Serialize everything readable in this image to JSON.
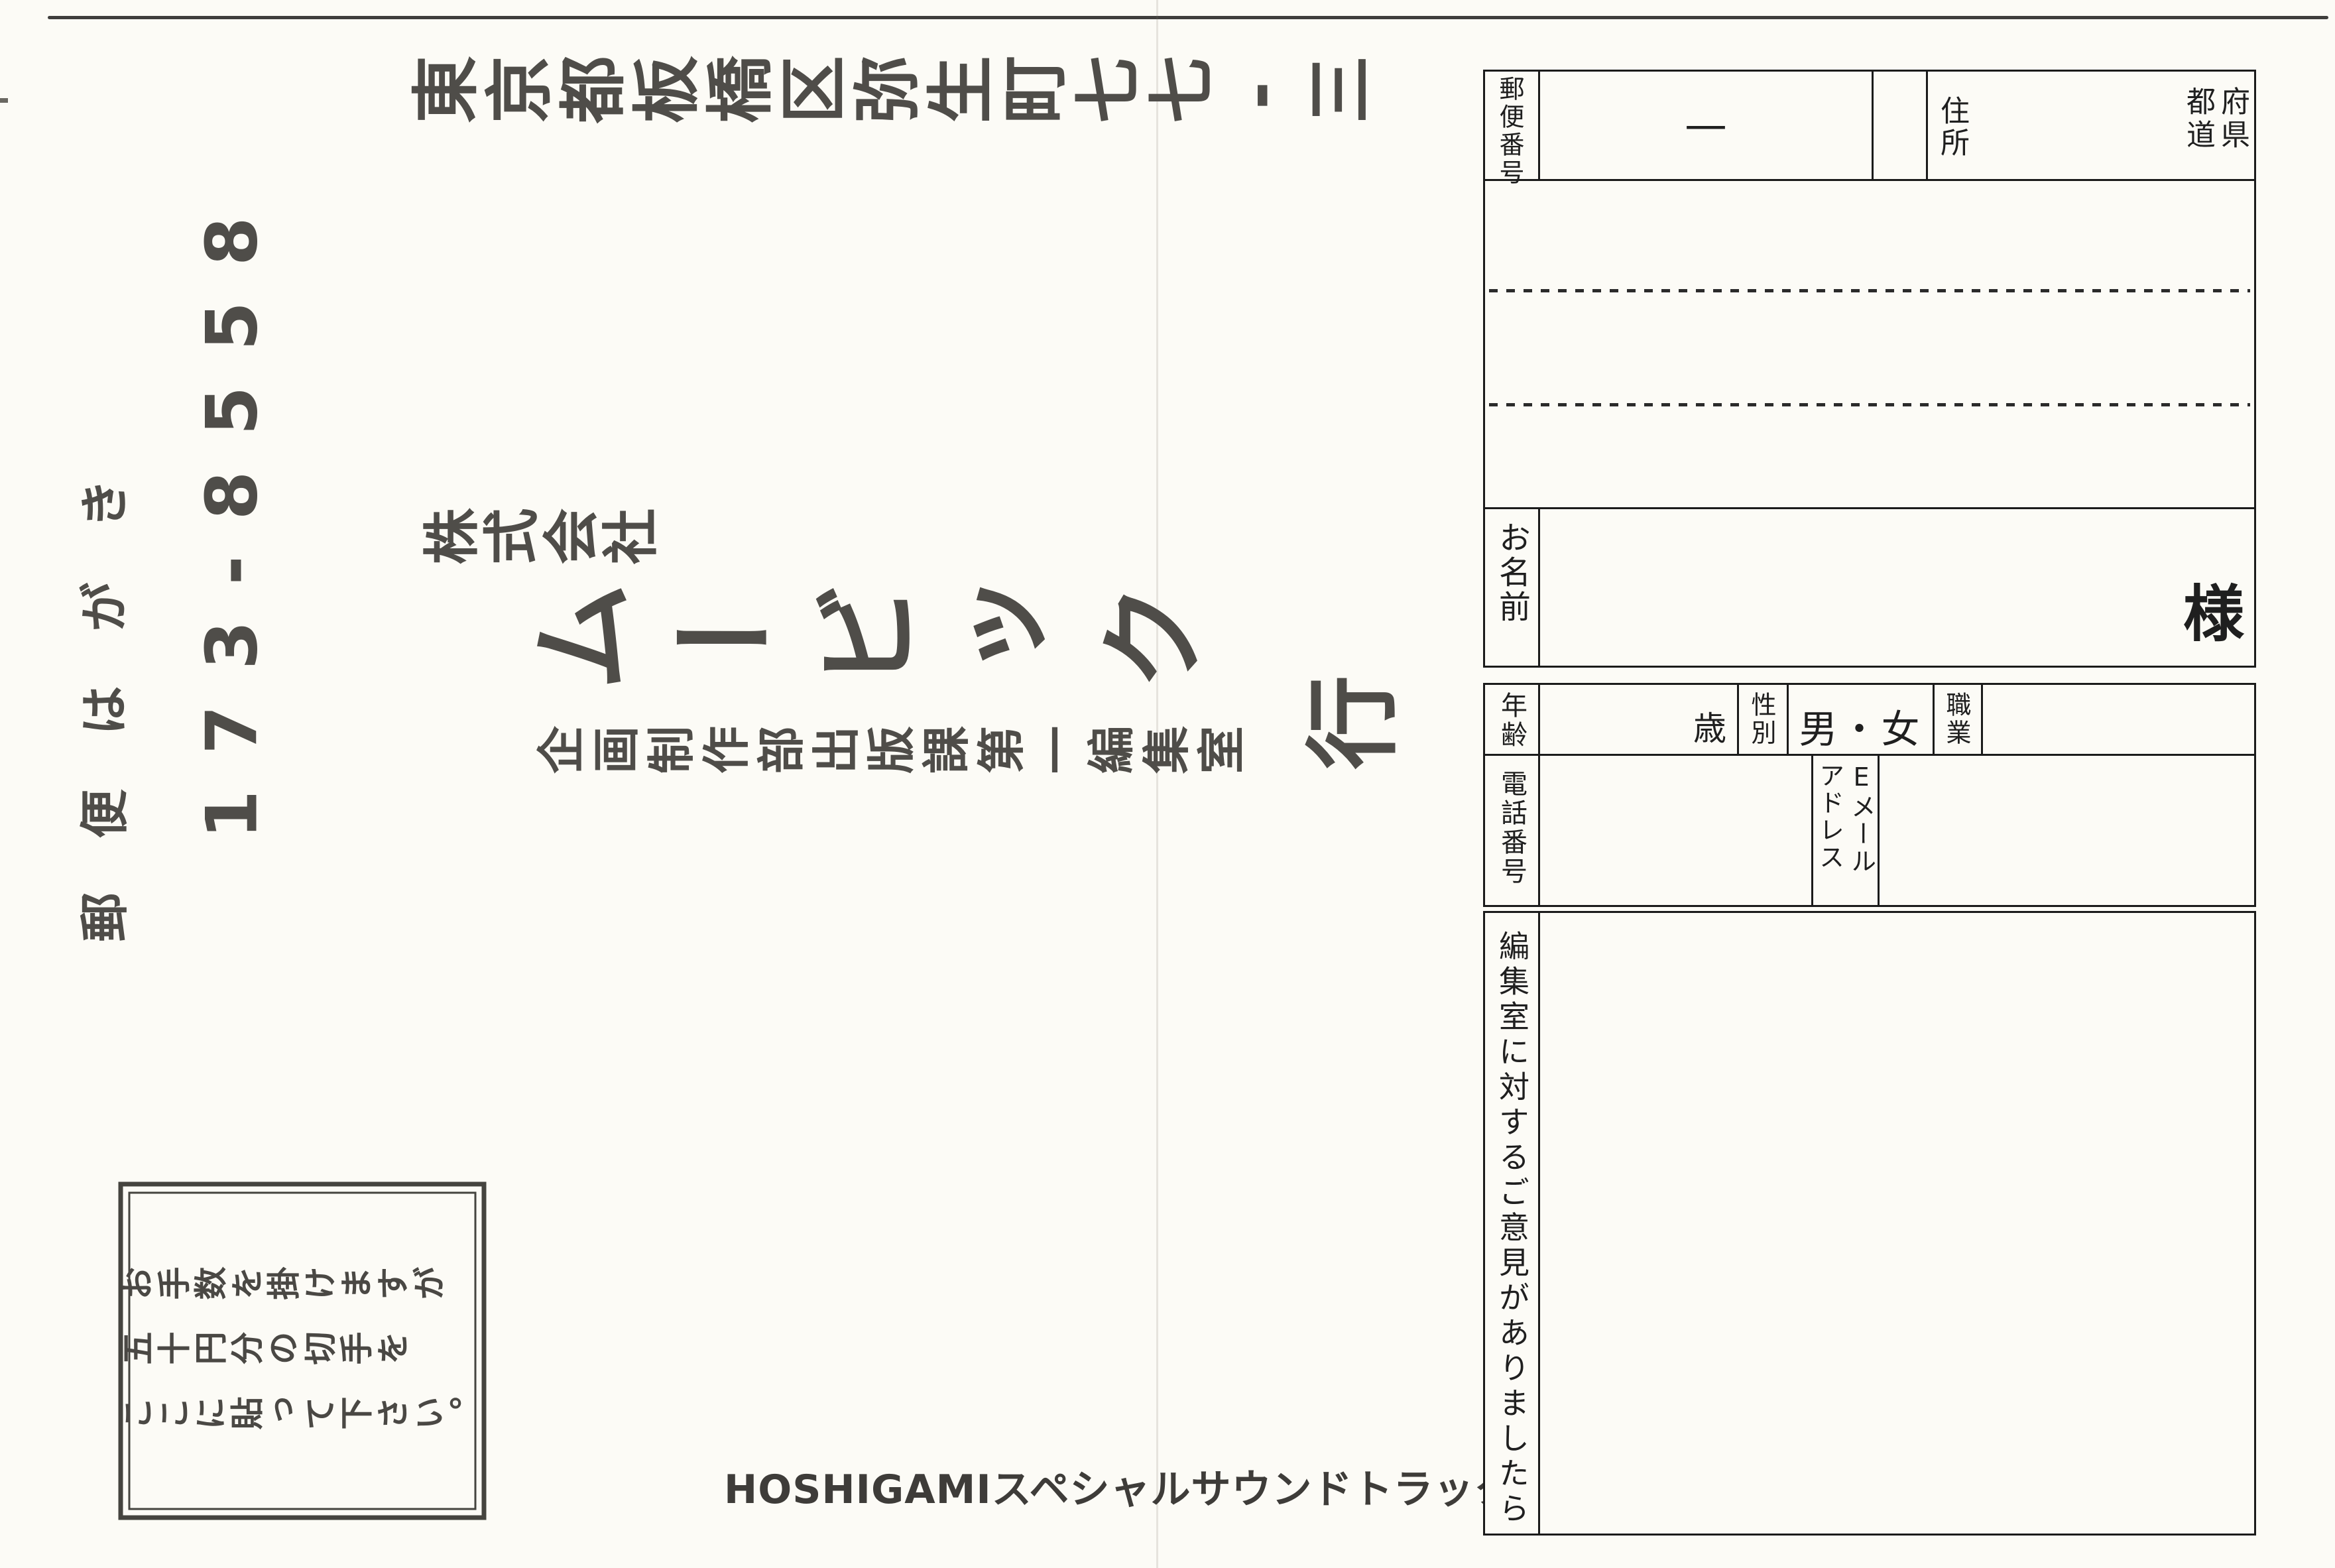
{
  "card": {
    "header": "郵便はがき",
    "postal_code": "173-8558",
    "address_line": "東京都板橋区弥生町七七-三",
    "company_prefix": "株式会社",
    "company_name": "ムービック",
    "honorific": "行",
    "department": "企画制作部出版課第一編集室",
    "stamp_box": {
      "line1": "お手数を掛けますが",
      "line2": "五十円分の切手を",
      "line3": "ここに貼って下さい。"
    },
    "footer_title": "HOSHIGAMIスペシャルサウンドトラック"
  },
  "form": {
    "postal_label": "郵便番号",
    "postal_dash": "—",
    "address_label": "住所",
    "prefecture_left": "都道",
    "prefecture_right": "府県",
    "name_label": "お名前",
    "name_suffix": "様",
    "age_label": "年齢",
    "age_unit": "歳",
    "sex_label": "性別",
    "sex_options": "男・女",
    "occupation_label": "職業",
    "phone_label": "電話番号",
    "email_label_line1": "Eメール",
    "email_label_line2": "アドレス",
    "opinion_label": "編集室に対するご意見がありましたら"
  },
  "colors": {
    "paper": "#fcfbf6",
    "ink_form": "#1b1b1b",
    "ink_print": "#4f4d49"
  }
}
